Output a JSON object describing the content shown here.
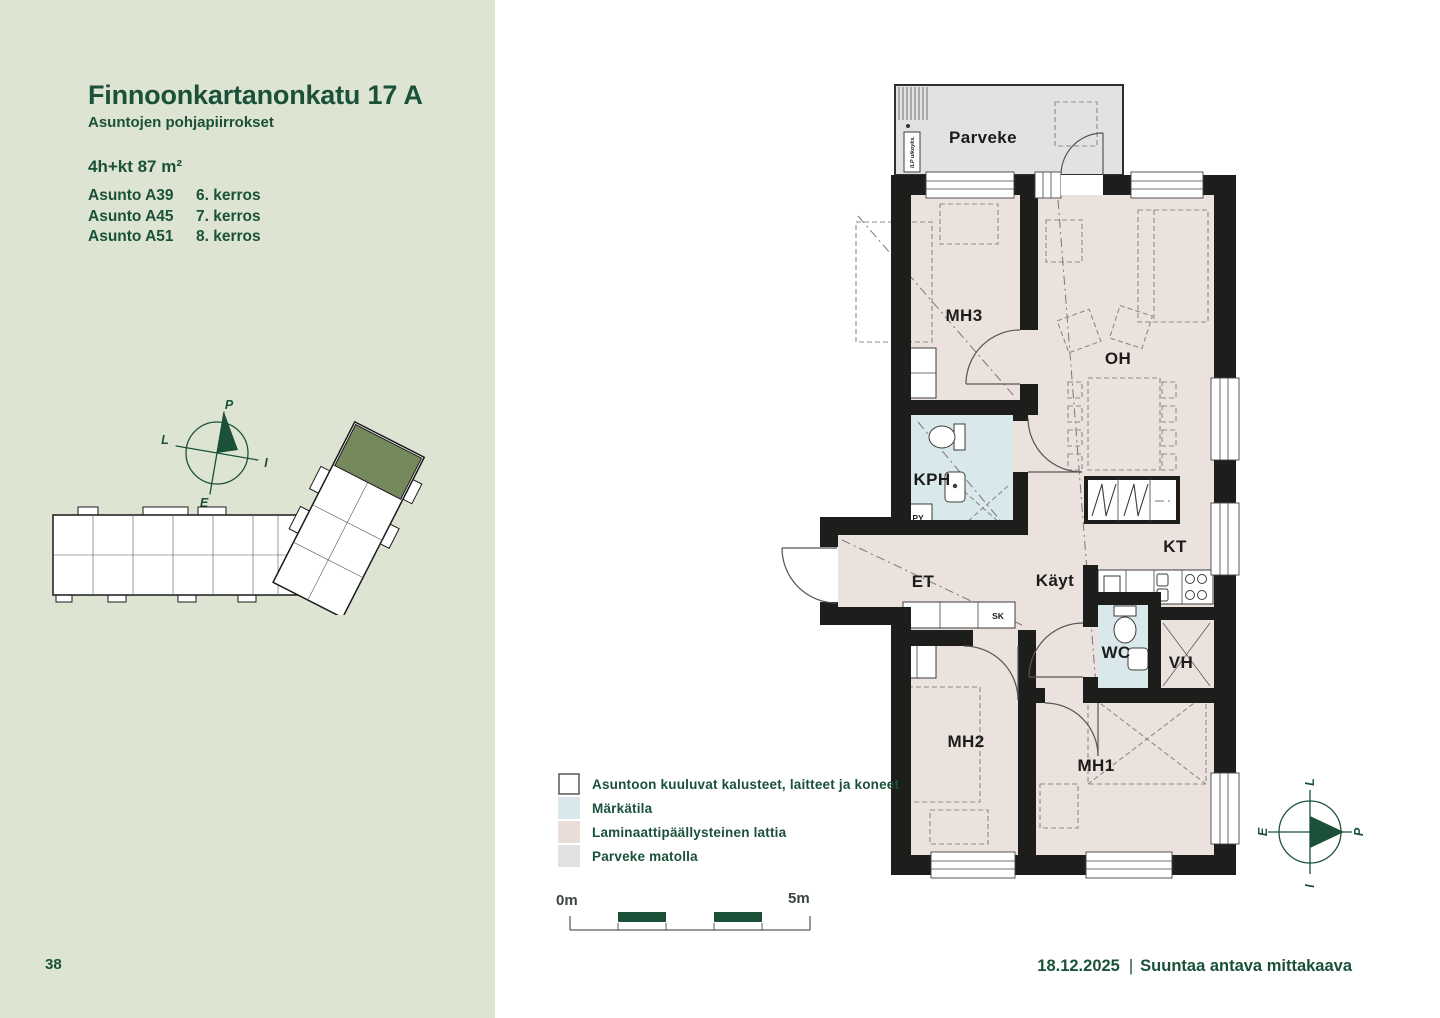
{
  "sidebar": {
    "title": "Finnoonkartanonkatu 17 A",
    "subtitle": "Asuntojen pohjapiirrokset",
    "unit_type": "4h+kt 87 m²",
    "apartments": [
      {
        "name": "Asunto A39",
        "floor": "6. kerros"
      },
      {
        "name": "Asunto A45",
        "floor": "7. kerros"
      },
      {
        "name": "Asunto A51",
        "floor": "8. kerros"
      }
    ],
    "page_number": "38"
  },
  "compass": {
    "north": "P",
    "west": "L",
    "east": "I",
    "south": "E"
  },
  "floorplan": {
    "rooms": {
      "balcony": "Parveke",
      "bedroom3": "MH3",
      "living": "OH",
      "bathroom": "KPH",
      "entry": "ET",
      "hall": "Käyt",
      "kitchen": "KT",
      "toilet": "WC",
      "closet": "VH",
      "bedroom2": "MH2",
      "bedroom1": "MH1"
    },
    "small_labels": {
      "washer": "PY",
      "cabinet": "SK",
      "ilp_outdoor": "ILP ulkoyks.",
      "ilp_indoor": "ILP sisäyks."
    }
  },
  "legend": {
    "items": [
      {
        "label": "Asuntoon kuuluvat kalusteet, laitteet ja koneet",
        "color": "#ffffff",
        "stroke": "#4a4a4a"
      },
      {
        "label": "Märkätila",
        "color": "#d9e9eb",
        "stroke": "none"
      },
      {
        "label": "Laminaattipäällysteinen lattia",
        "color": "#eadcd7",
        "stroke": "none"
      },
      {
        "label": "Parveke matolla",
        "color": "#e2e3e1",
        "stroke": "none"
      }
    ]
  },
  "scalebar": {
    "start": "0m",
    "end": "5m"
  },
  "footer": {
    "date": "18.12.2025",
    "separator": "|",
    "note": "Suuntaa antava mittakaava"
  },
  "colors": {
    "sidebar_bg": "#dde4d2",
    "dark_green": "#1a5138",
    "wall": "#1d1d1b",
    "laminate": "#ece2dd",
    "wet_room": "#d9e9eb",
    "balcony": "#e2e3e1",
    "keyplan_highlight": "#75895d"
  }
}
